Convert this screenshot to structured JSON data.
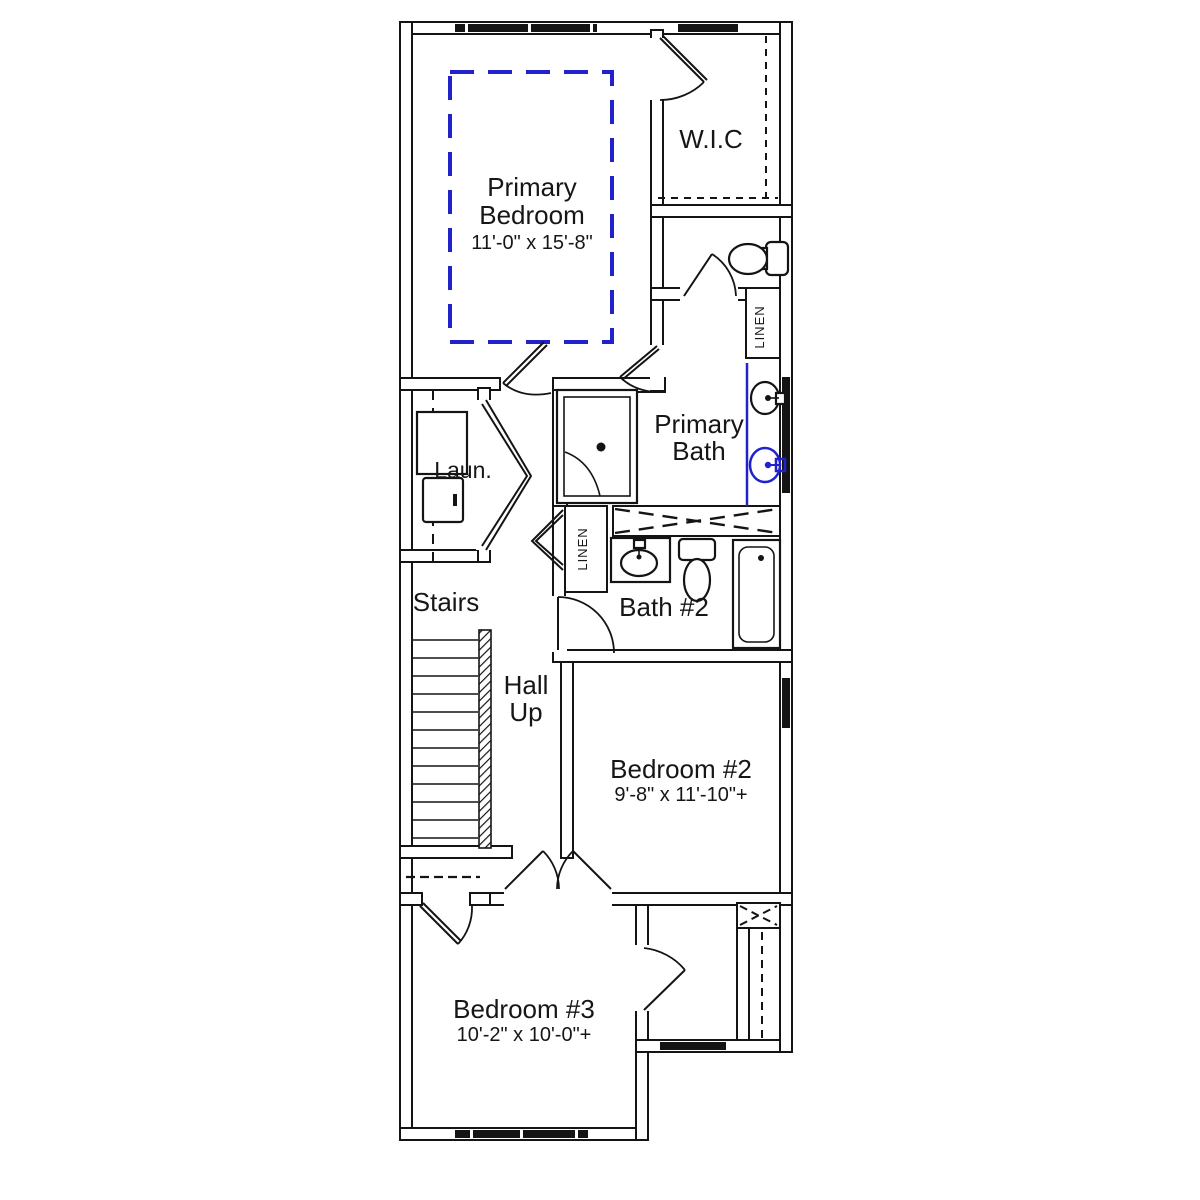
{
  "plan": {
    "background": "#ffffff",
    "wall_color": "#141414",
    "accent_blue": "#2222cc",
    "rooms": {
      "primary_bedroom": {
        "line1": "Primary",
        "line2": "Bedroom",
        "dims": "11'-0\" x 15'-8\""
      },
      "wic": {
        "label": "W.I.C"
      },
      "primary_bath": {
        "line1": "Primary",
        "line2": "Bath"
      },
      "laundry": {
        "label": "Laun."
      },
      "linen_upper": {
        "label": "LINEN"
      },
      "linen_hall": {
        "label": "LINEN"
      },
      "stairs": {
        "label": "Stairs"
      },
      "hall": {
        "line1": "Hall",
        "line2": "Up"
      },
      "bath2": {
        "label": "Bath #2"
      },
      "bedroom2": {
        "name": "Bedroom #2",
        "dims": "9'-8\" x 11'-10\"+"
      },
      "bedroom3": {
        "name": "Bedroom #3",
        "dims": "10'-2\" x 10'-0\"+"
      }
    }
  }
}
